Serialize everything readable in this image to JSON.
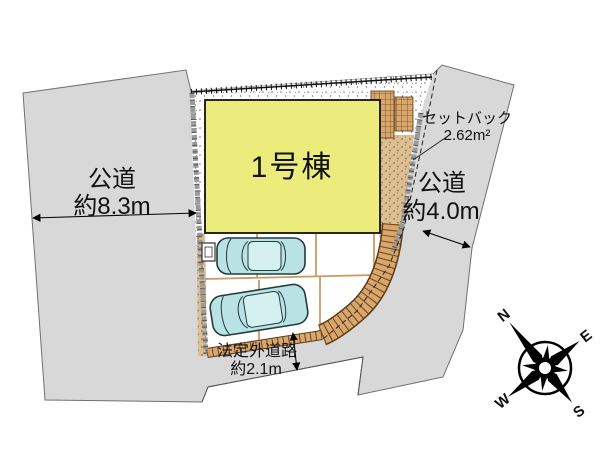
{
  "diagram": {
    "building": {
      "label": "1号棟"
    },
    "roads": {
      "left": {
        "name": "公道",
        "width": "約8.3m"
      },
      "right": {
        "name": "公道",
        "width": "約4.0m"
      },
      "bottom": {
        "name": "法定外道路",
        "width": "約2.1m"
      }
    },
    "setback": {
      "label": "セットバック",
      "area": "2.62m²"
    },
    "compass": {
      "n": "N",
      "e": "E",
      "s": "S",
      "w": "W"
    },
    "colors": {
      "road_fill": "#d8d8d8",
      "building_fill": "#ecec7c",
      "brick": "#d9a76b",
      "dirt": "#dbbe92",
      "car_body": "#b9e2e4",
      "compass": "#000000"
    }
  }
}
